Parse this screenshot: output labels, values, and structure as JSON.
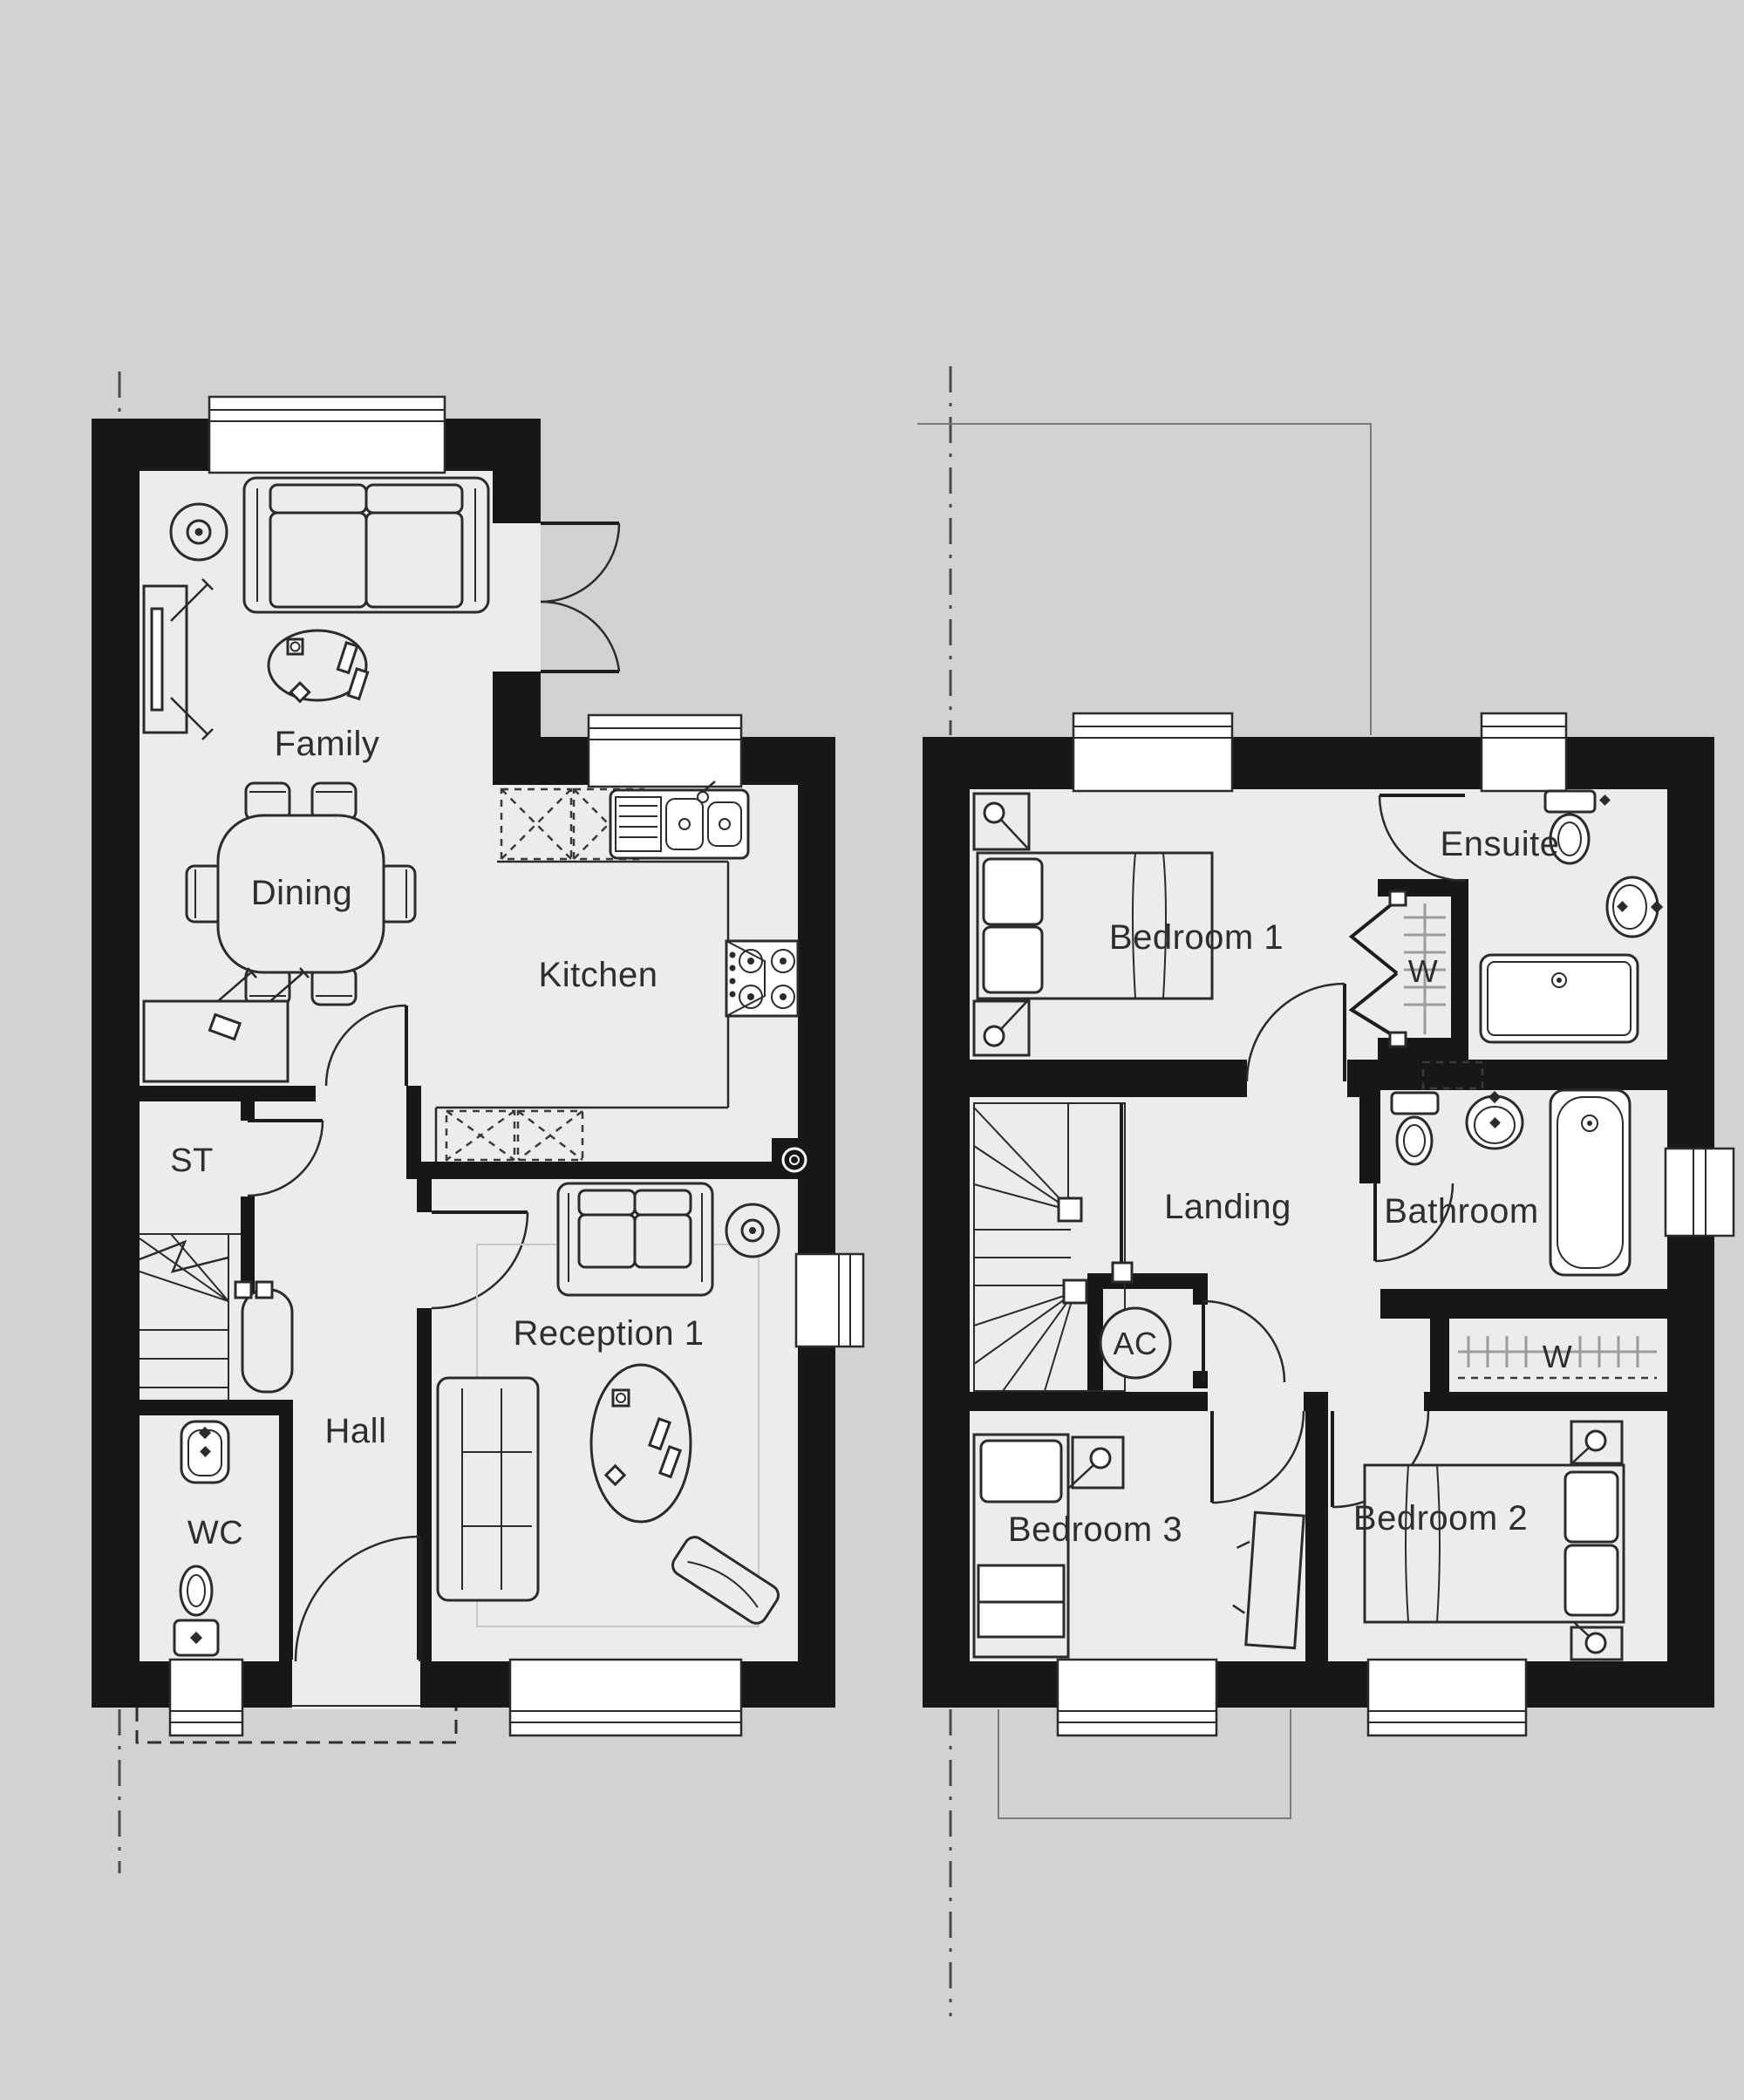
{
  "document": {
    "type": "house-floorplan-drawing",
    "floors": [
      "Ground Floor",
      "First Floor"
    ],
    "background_color": "#d2d2d3",
    "floor_fill_color": "#ececed",
    "wall_color": "#171717",
    "line_color": "#2b2b2b"
  },
  "ground_floor": {
    "rooms": {
      "family": {
        "label": "Family",
        "features": [
          "sofa",
          "coffee-table",
          "tv-unit",
          "side-table",
          "ceiling-light",
          "french-doors",
          "window"
        ]
      },
      "dining": {
        "label": "Dining",
        "features": [
          "dining-table",
          "six-chairs",
          "sideboard"
        ]
      },
      "kitchen": {
        "label": "Kitchen",
        "features": [
          "sink",
          "hob",
          "worktops",
          "base-units",
          "boiler",
          "window"
        ]
      },
      "st": {
        "label": "ST",
        "features": [
          "store-cupboard"
        ]
      },
      "hall": {
        "label": "Hall",
        "features": [
          "stairs",
          "front-door"
        ]
      },
      "wc": {
        "label": "WC",
        "features": [
          "toilet",
          "basin",
          "window"
        ]
      },
      "reception": {
        "label": "Reception 1",
        "features": [
          "two-sofas",
          "oval-table",
          "tv",
          "ceiling-light",
          "rug",
          "windows"
        ]
      }
    }
  },
  "first_floor": {
    "rooms": {
      "bedroom1": {
        "label": "Bedroom 1",
        "features": [
          "double-bed",
          "bedside-tables",
          "lamps",
          "window"
        ]
      },
      "ensuite": {
        "label": "Ensuite",
        "features": [
          "toilet",
          "basin",
          "shower",
          "window"
        ]
      },
      "wardrobe_ensuite": {
        "label": "W",
        "features": [
          "bifold-doors",
          "hanging-rail"
        ]
      },
      "landing": {
        "label": "Landing",
        "features": [
          "stairs"
        ]
      },
      "bathroom": {
        "label": "Bathroom",
        "features": [
          "toilet",
          "basin",
          "bath",
          "window"
        ]
      },
      "ac": {
        "label": "AC",
        "features": [
          "airing-cupboard"
        ]
      },
      "wardrobe_landing": {
        "label": "W",
        "features": [
          "hanging-rail"
        ]
      },
      "bedroom3": {
        "label": "Bedroom 3",
        "features": [
          "single-bed",
          "desk",
          "window"
        ]
      },
      "bedroom2": {
        "label": "Bedroom 2",
        "features": [
          "double-bed",
          "bedside-tables",
          "lamps",
          "window"
        ]
      }
    }
  }
}
